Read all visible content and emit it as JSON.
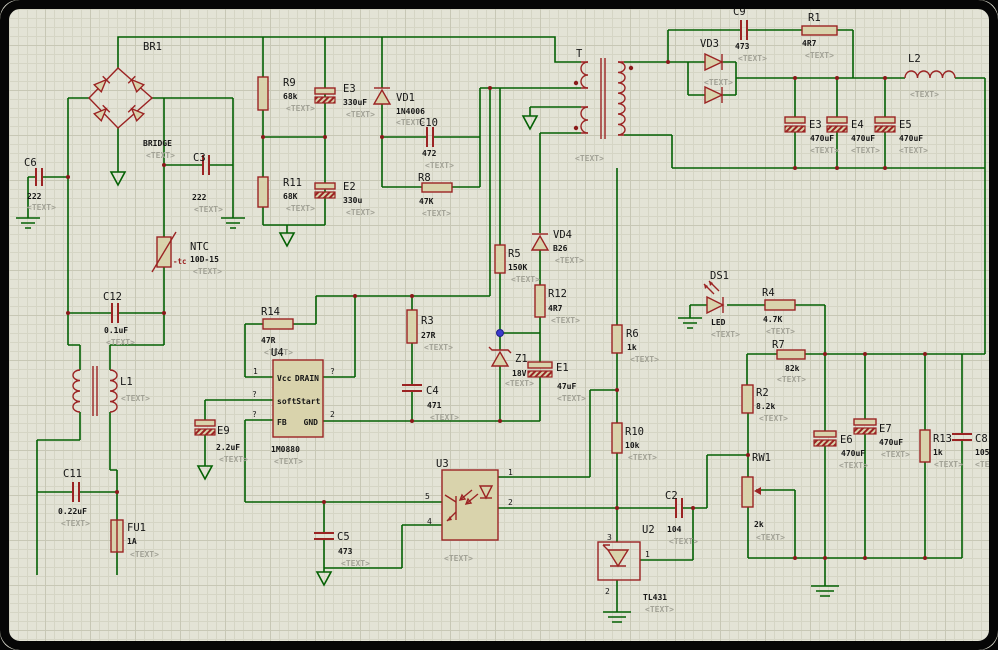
{
  "ph": "<TEXT>",
  "colors": {
    "sheet": "#e3e3d6",
    "grid": "#d5d5c5",
    "wire": "#046104",
    "component": "#9b2323",
    "label": "#161616",
    "placeholder": "#a2a296",
    "origin_dot": "#3a3acc"
  },
  "c": {
    "br1": {
      "r": "BR1",
      "v": "BRIDGE"
    },
    "c6": {
      "r": "C6",
      "v": "222"
    },
    "c3": {
      "r": "C3",
      "v": "222"
    },
    "r9": {
      "r": "R9",
      "v": "68k"
    },
    "e3a": {
      "r": "E3",
      "v": "330uF"
    },
    "r11": {
      "r": "R11",
      "v": "68K"
    },
    "e2": {
      "r": "E2",
      "v": "330u"
    },
    "vd1": {
      "r": "VD1",
      "v": "1N4006"
    },
    "c10": {
      "r": "C10",
      "v": "472"
    },
    "r8": {
      "r": "R8",
      "v": "47K"
    },
    "ntc": {
      "r": "NTC",
      "v": "10D-15",
      "tc": "-tc"
    },
    "c12": {
      "r": "C12",
      "v": "0.1uF"
    },
    "l1": {
      "r": "L1"
    },
    "c11": {
      "r": "C11",
      "v": "0.22uF"
    },
    "fu1": {
      "r": "FU1",
      "v": "1A"
    },
    "e9": {
      "r": "E9",
      "v": "2.2uF"
    },
    "r14": {
      "r": "R14",
      "v": "47R"
    },
    "u4": {
      "r": "U4",
      "v": "1M0880",
      "l_vcc": "Vcc",
      "l_drain": "DRAIN",
      "l_soft": "softStart",
      "l_fb": "FB",
      "l_gnd": "GND",
      "p1": "1",
      "p2": "2",
      "pq": "?"
    },
    "r3": {
      "r": "R3",
      "v": "27R"
    },
    "c4": {
      "r": "C4",
      "v": "471"
    },
    "r5": {
      "r": "R5",
      "v": "150K"
    },
    "vd4": {
      "r": "VD4",
      "v": "B26"
    },
    "r12": {
      "r": "R12",
      "v": "4R7"
    },
    "z1": {
      "r": "Z1",
      "v": "18V"
    },
    "e1": {
      "r": "E1",
      "v": "47uF"
    },
    "c5": {
      "r": "C5",
      "v": "473"
    },
    "u3": {
      "r": "U3",
      "p1": "1",
      "p2": "2",
      "p4": "4",
      "p5": "5"
    },
    "t": {
      "r": "T"
    },
    "c9": {
      "r": "C9",
      "v": "473"
    },
    "r1": {
      "r": "R1",
      "v": "4R7"
    },
    "vd3": {
      "r": "VD3"
    },
    "l2": {
      "r": "L2"
    },
    "e3b": {
      "r": "E3",
      "v": "470uF"
    },
    "e4": {
      "r": "E4",
      "v": "470uF"
    },
    "e5": {
      "r": "E5",
      "v": "470uF"
    },
    "ds1": {
      "r": "DS1",
      "v": "LED"
    },
    "r4": {
      "r": "R4",
      "v": "4.7K"
    },
    "r7": {
      "r": "R7",
      "v": "82k"
    },
    "r6": {
      "r": "R6",
      "v": "1k"
    },
    "r2": {
      "r": "R2",
      "v": "8.2k"
    },
    "rw1": {
      "r": "RW1",
      "v": "2k"
    },
    "e6": {
      "r": "E6",
      "v": "470uF"
    },
    "e7": {
      "r": "E7",
      "v": "470uF"
    },
    "r13": {
      "r": "R13",
      "v": "1k"
    },
    "c8": {
      "r": "C8",
      "v": "105"
    },
    "r10": {
      "r": "R10",
      "v": "10k"
    },
    "c2": {
      "r": "C2",
      "v": "104"
    },
    "u2": {
      "r": "U2",
      "v": "TL431",
      "p1": "1",
      "p2": "2",
      "p3": "3"
    }
  }
}
